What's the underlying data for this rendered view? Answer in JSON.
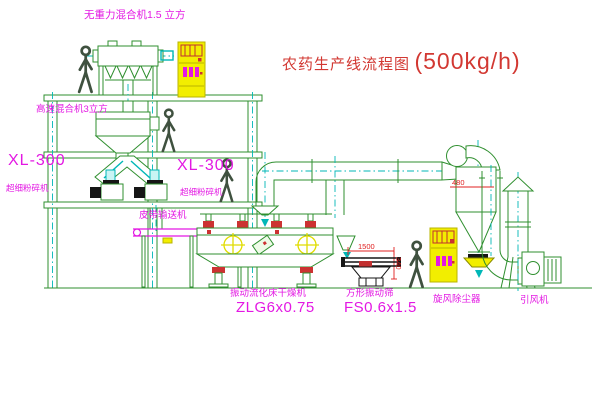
{
  "diagram": {
    "title": "农药生产线流程图",
    "capacity": "(500kg/h)"
  },
  "labels": {
    "gravity_free_mixer": "无重力混合机1.5 立方",
    "high_speed_mixer": "高速混合机3立方",
    "mill_left_model": "XL-300",
    "mill_left_name": "超细粉碎机",
    "mill_mid_model": "XL-300",
    "mill_mid_name": "超细粉碎机",
    "belt_conveyor": "皮带输送机",
    "fluid_bed_name": "振动流化床干燥机",
    "fluid_bed_model": "ZLG6x0.75",
    "sieve_name": "方形振动筛",
    "sieve_model": "FS0.6x1.5",
    "cyclone": "旋风除尘器",
    "fan": "引风机"
  },
  "dimensions": {
    "sieve_length": "1500",
    "sieve_height": "340",
    "cyclone_width": "480"
  },
  "colors": {
    "line_green": "#2f8f2f",
    "centerline_cyan": "#00b7b7",
    "label_magenta": "#e318e3",
    "title_red": "#d23832",
    "cabinet_yellow": "#f2ee00",
    "dimension_red": "#e02020"
  }
}
